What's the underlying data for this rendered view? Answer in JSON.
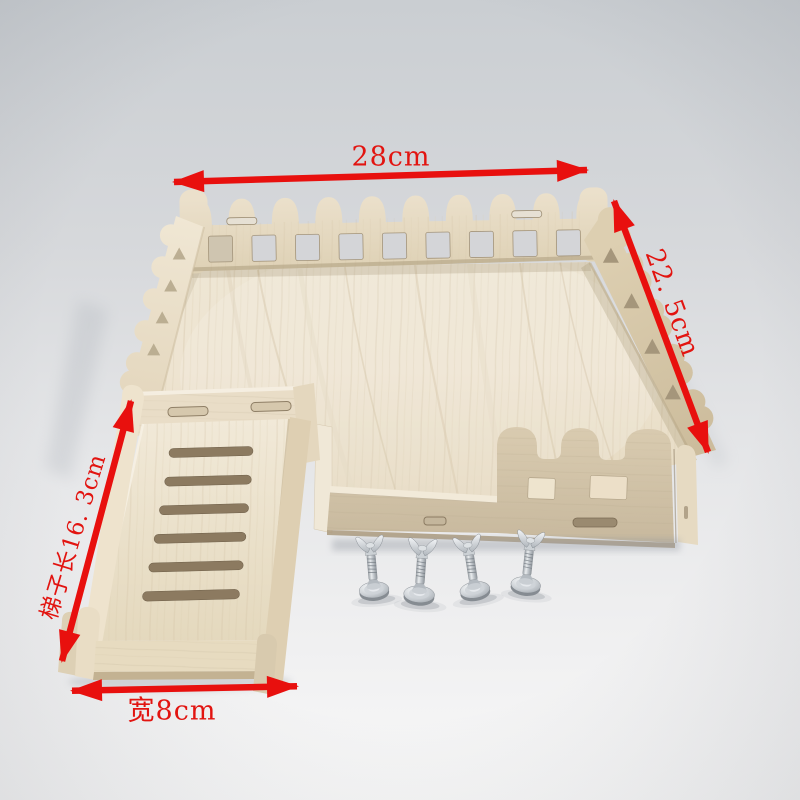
{
  "image": {
    "kind": "product photo",
    "subject": "wooden pet playpen platform with picket fence, climbing ladder and wing-nut screws",
    "background_top_color": "#cbced2",
    "background_bottom_color": "#f8f8f8",
    "wood_color": "#e9dec8",
    "annotation_color": "#e8100e"
  },
  "annotations": {
    "top_width": {
      "label": "28cm"
    },
    "right_depth": {
      "label": "22. 5cm"
    },
    "ladder_length": {
      "label": "梯子长16. 3cm"
    },
    "bottom_width": {
      "label": "宽8cm"
    }
  },
  "parts": {
    "fence": "picket-fence walls with square windows and triangle cutouts",
    "floor": "wood-grain platform deck",
    "front_wall": "castellated front wall with two windows",
    "ladder": "slotted climbing ramp with side rails",
    "hardware": "four wing-nut leveling screws"
  }
}
